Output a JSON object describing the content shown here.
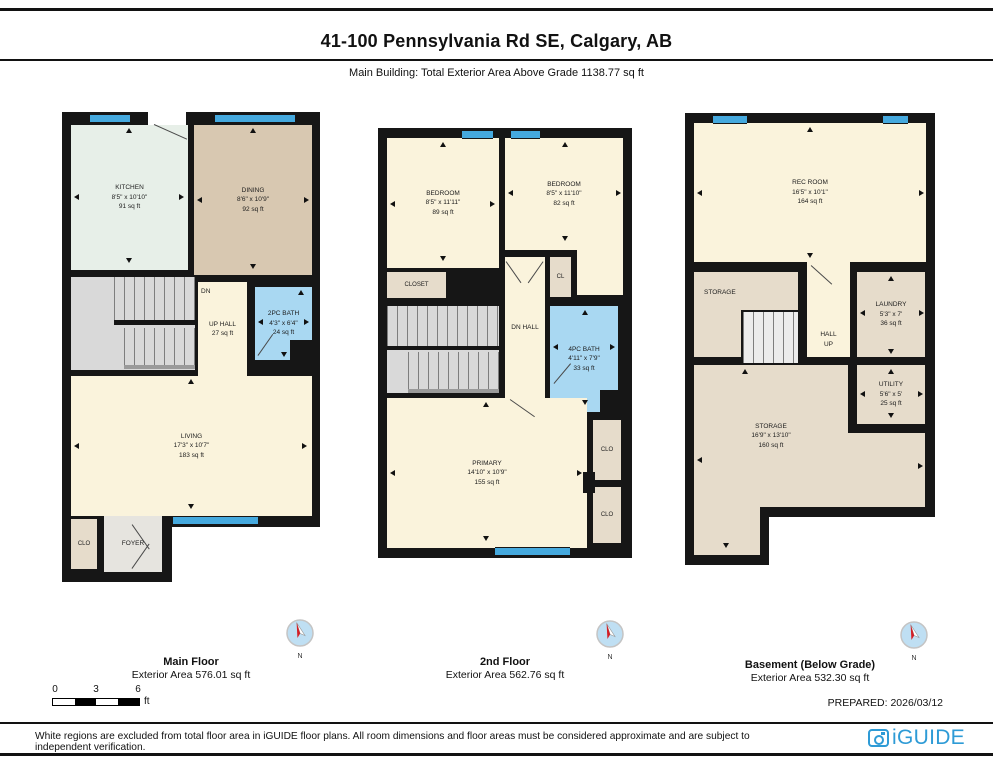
{
  "header": {
    "title": "41-100 Pennsylvania Rd SE, Calgary, AB",
    "subtitle": "Main Building: Total Exterior Area Above Grade 1138.77 sq ft"
  },
  "floors": [
    {
      "name": "Main Floor",
      "area": "Exterior Area 576.01 sq ft"
    },
    {
      "name": "2nd Floor",
      "area": "Exterior Area 562.76 sq ft"
    },
    {
      "name": "Basement (Below Grade)",
      "area": "Exterior Area 532.30 sq ft"
    }
  ],
  "plans": {
    "main": {
      "kitchen": {
        "name": "KITCHEN",
        "dims": "8'5\" x 10'10\"",
        "area": "91 sq ft"
      },
      "dining": {
        "name": "DINING",
        "dims": "8'6\" x 10'9\"",
        "area": "92 sq ft"
      },
      "bath": {
        "name": "2PC BATH",
        "dims": "4'3\" x 6'4\"",
        "area": "24 sq ft"
      },
      "hall": {
        "dn": "DN",
        "up": "UP",
        "name": "HALL",
        "area": "27 sq ft"
      },
      "living": {
        "name": "LIVING",
        "dims": "17'3\" x 10'7\"",
        "area": "183 sq ft"
      },
      "clo": {
        "name": "CLO"
      },
      "foyer": {
        "name": "FOYER"
      }
    },
    "second": {
      "bedroom1": {
        "name": "BEDROOM",
        "dims": "8'5\" x 11'11\"",
        "area": "89 sq ft"
      },
      "bedroom2": {
        "name": "BEDROOM",
        "dims": "8'5\" x 11'10\"",
        "area": "82 sq ft"
      },
      "closet": {
        "name": "CLOSET"
      },
      "cl": {
        "name": "CL"
      },
      "hall": {
        "dn": "DN",
        "name": "HALL"
      },
      "bath": {
        "name": "4PC BATH",
        "dims": "4'11\" x 7'9\"",
        "area": "33 sq ft"
      },
      "primary": {
        "name": "PRIMARY",
        "dims": "14'10\" x 10'9\"",
        "area": "155 sq ft"
      },
      "clo1": {
        "name": "CLO"
      },
      "clo2": {
        "name": "CLO"
      }
    },
    "basement": {
      "rec": {
        "name": "REC ROOM",
        "dims": "16'5\" x 10'1\"",
        "area": "164 sq ft"
      },
      "storage1": {
        "name": "STORAGE"
      },
      "laundry": {
        "name": "LAUNDRY",
        "dims": "5'3\" x 7'",
        "area": "36 sq ft"
      },
      "hall": {
        "name": "HALL",
        "up": "UP"
      },
      "utility": {
        "name": "UTILITY",
        "dims": "5'6\" x 5'",
        "area": "25 sq ft"
      },
      "storage2": {
        "name": "STORAGE",
        "dims": "16'9\" x 13'10\"",
        "area": "160 sq ft"
      }
    }
  },
  "compass": {
    "label": "N"
  },
  "scale_bar": {
    "ticks": [
      "0",
      "3",
      "6"
    ],
    "unit": "ft"
  },
  "footer": {
    "prepared": "PREPARED: 2026/03/12",
    "disclaimer": "White regions are excluded from total floor area in iGUIDE floor plans. All room dimensions and floor areas must be considered approximate and are subject to independent verification.",
    "brand": "iGUIDE"
  },
  "colors": {
    "wall": "#161616",
    "room_cream": "#FAF3DC",
    "dining_tan": "#D8C8B1",
    "closet_tan": "#E6DCCB",
    "kitchen_mint": "#E7EFE8",
    "bath_blue": "#A9D8F2",
    "window_blue": "#45A9DE",
    "stair_gray": "#D9D9D9",
    "foyer_gray": "#E6E4DF",
    "brand_blue": "#2E9BD6",
    "compass_red": "#D31F26"
  }
}
